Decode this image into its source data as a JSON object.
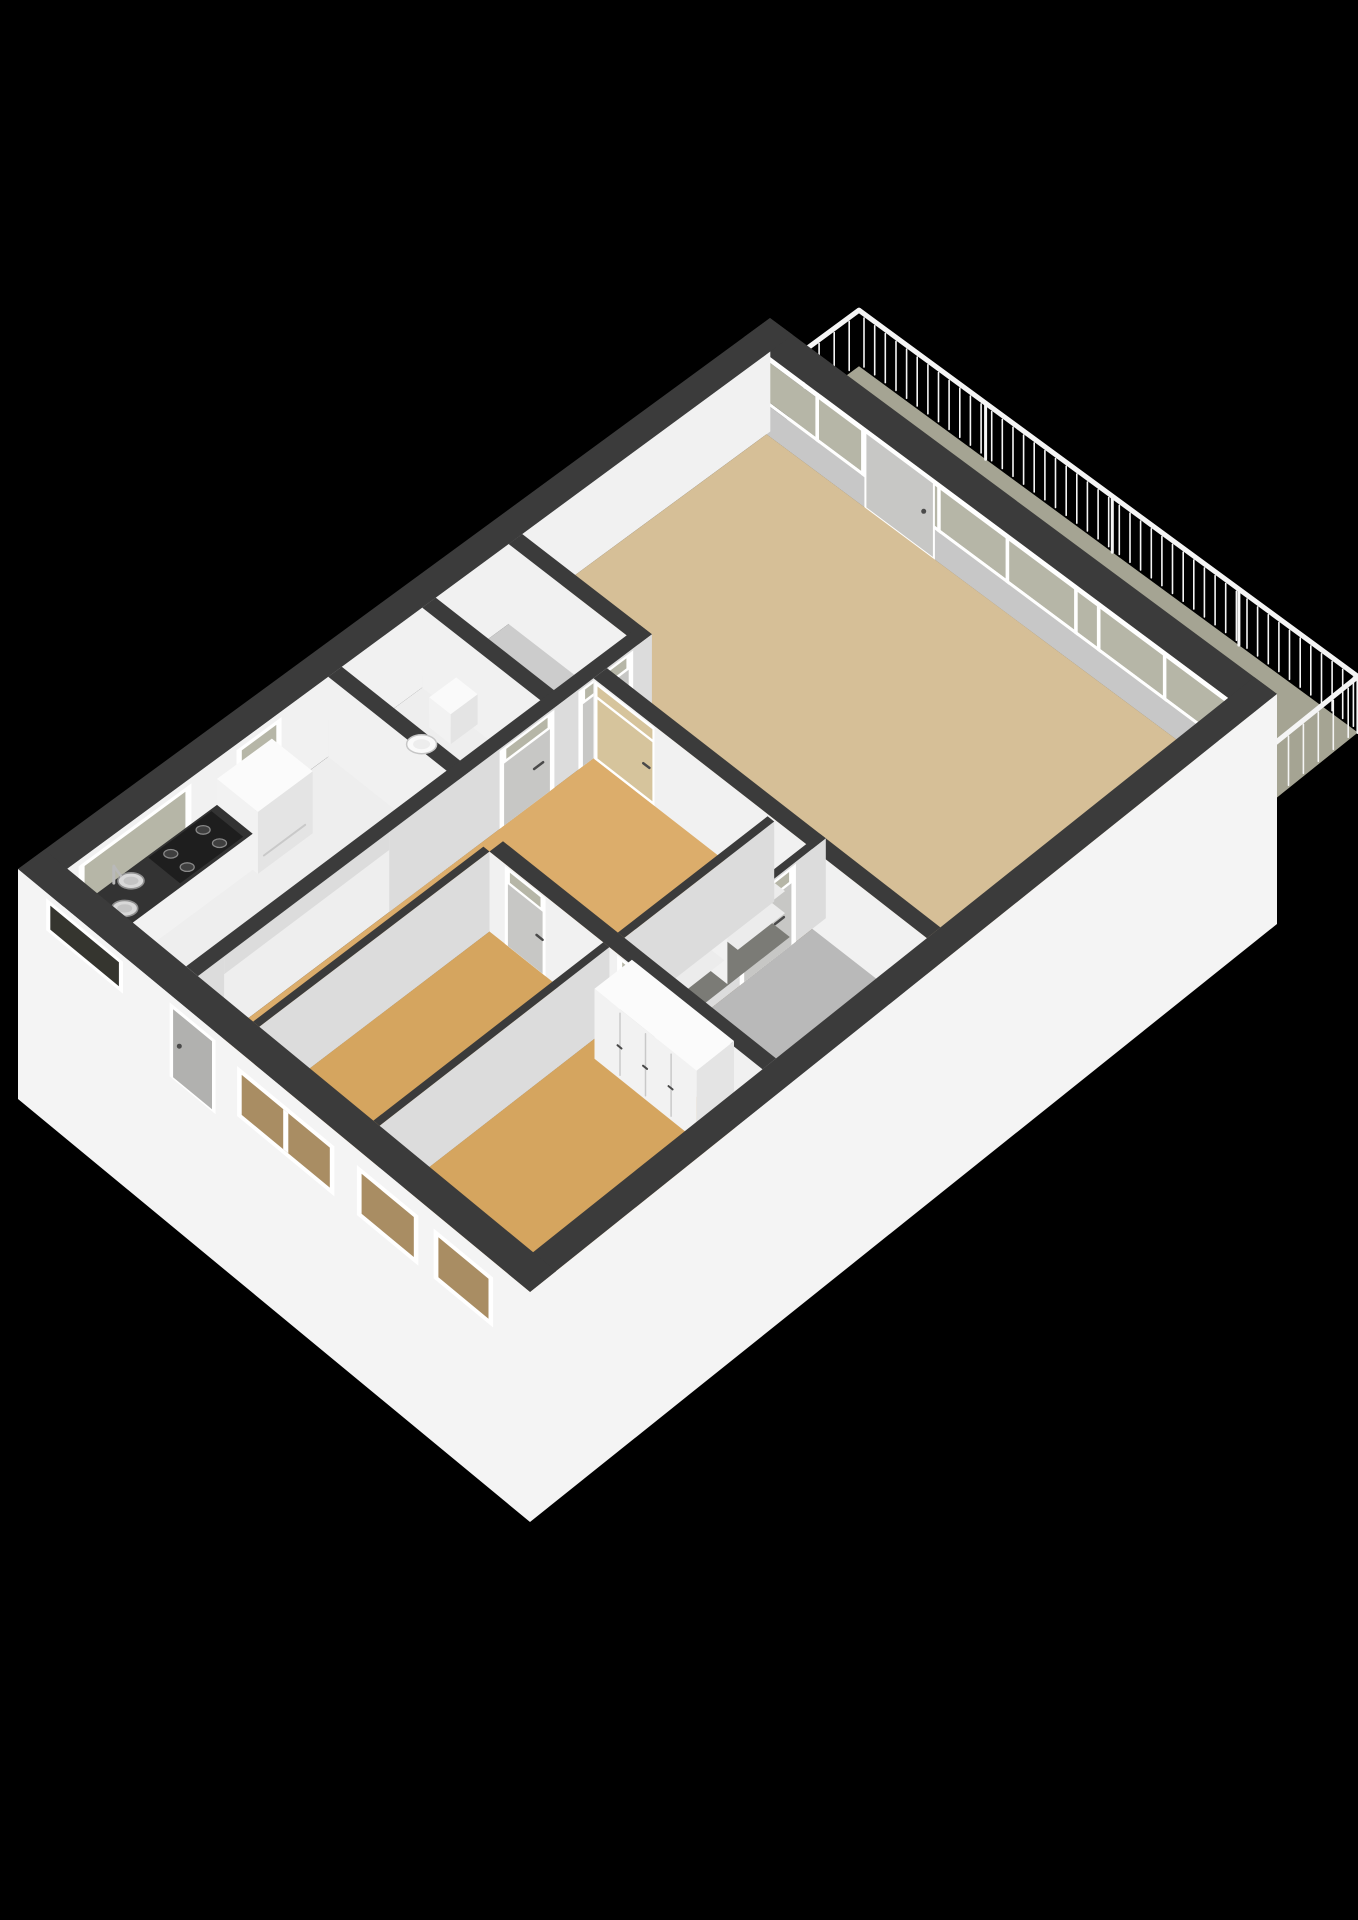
{
  "title": "3D isometric floor plan render of an apartment on a black background",
  "background": "#000000",
  "palette": {
    "bg": "#000000",
    "cap": "#3b3b3b",
    "faceB": "#f1f1f1",
    "faceA": "#dcdcdc",
    "faceShadow": "#c7c7c7",
    "extFace": "#f4f4f4",
    "floorWhite": "#eeeeee",
    "floorLiving": "#d6bf97",
    "floorHall": "#dcad6b",
    "floorBed": "#d5a55f",
    "floorBath": "#b9b9b9",
    "floorStorage": "#cccccc",
    "balconyFloor": "#a5a493",
    "recess": "#7b7b76",
    "glass": "#b6b6a7",
    "glassDark": "#35352f",
    "glassBed": "#a98d63",
    "glassWarm": "#d6c49c",
    "frame": "#ffffff",
    "doorPanel": "#c7c7c5",
    "doorDark": "#b1b1af",
    "counterTop": "#333333",
    "stove": "#1e1e1e",
    "steel": "#d8d8d8",
    "steelDark": "#8f8f8f",
    "fixture": "#fafafa",
    "shelf": "#ececec",
    "handle": "#4a4a4a",
    "railing": "#f5f5f5",
    "boxTop": "#fbfbfb",
    "boxA": "#e4e4e4",
    "boxB": "#f2f2f2",
    "seam": "#c9c9c9",
    "slat": "#2f2f2f"
  },
  "render": {
    "wall_height_px": 80,
    "parapet_height_px": 30,
    "exterior_skirt_px": 150,
    "rail_height_px": 56,
    "baluster_step": 0.021,
    "door_height_px": 62
  },
  "rooms": [
    {
      "id": "balcony",
      "label": "Balcony",
      "floor": "balconyFloor"
    },
    {
      "id": "living-room",
      "label": "Living room",
      "floor": "floorLiving"
    },
    {
      "id": "storage-room",
      "label": "Storage room",
      "floor": "floorStorage"
    },
    {
      "id": "wc",
      "label": "WC",
      "floor": "floorWhite"
    },
    {
      "id": "kitchen",
      "label": "Kitchen",
      "floor": "floorWhite"
    },
    {
      "id": "hallway",
      "label": "Hallway",
      "floor": "floorHall"
    },
    {
      "id": "bathroom",
      "label": "Bathroom",
      "floor": "floorBath"
    },
    {
      "id": "bedroom-1",
      "label": "Bedroom 1",
      "floor": "floorBed"
    },
    {
      "id": "bedroom-2",
      "label": "Bedroom 2",
      "floor": "floorBed"
    }
  ],
  "fixtures": {
    "balcony-railing": "Balcony railing with balusters",
    "balcony-door": "Balcony door",
    "glazed-wall": "Glazed wall with windows to balcony",
    "kitchen-counter": "Kitchen counter",
    "kitchen-sink": "Double kitchen sink with faucet",
    "stove": "Four burner stove",
    "refrigerator": "Refrigerator",
    "dish-rack": "Dish rack",
    "toilet": "Toilet",
    "wardrobe": "Built-in wardrobe closets",
    "cupboard-shelves": "Built-in cupboard with shelves",
    "entrance-door": "Entrance door",
    "interior-doors": "Interior doors with transom windows",
    "windows": "Exterior windows"
  }
}
